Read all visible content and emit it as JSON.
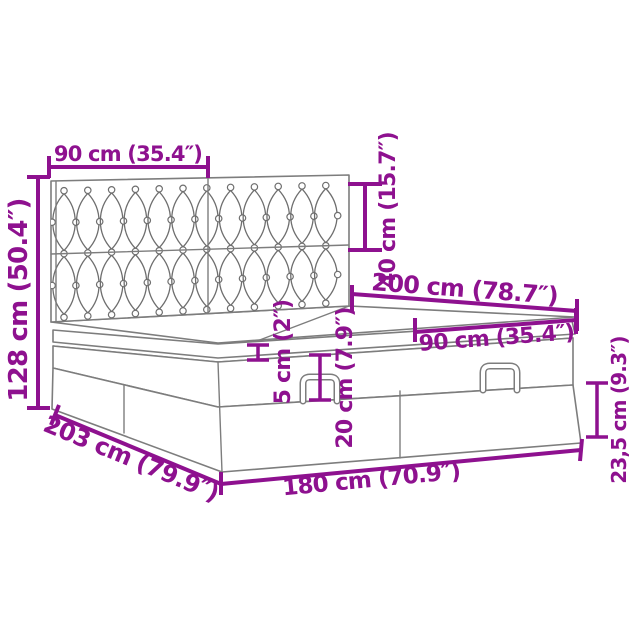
{
  "diagram": {
    "accent_color": "#8E118F",
    "line_color": "#7d7d7d",
    "labels": {
      "headboard_section_width": "90 cm (35.4″)",
      "overall_height": "128 cm (50.4″)",
      "headboard_height": "40 cm (15.7″)",
      "bed_length": "200 cm (78.7″)",
      "mattress_section_width": "90 cm (35.4″)",
      "topper_thickness": "5 cm (2″)",
      "mattress_thickness": "20 cm (7.9″)",
      "base_height": "23,5 cm (9.3″)",
      "frame_length": "203 cm (79.9″)",
      "frame_width": "180 cm (70.9″)"
    }
  }
}
